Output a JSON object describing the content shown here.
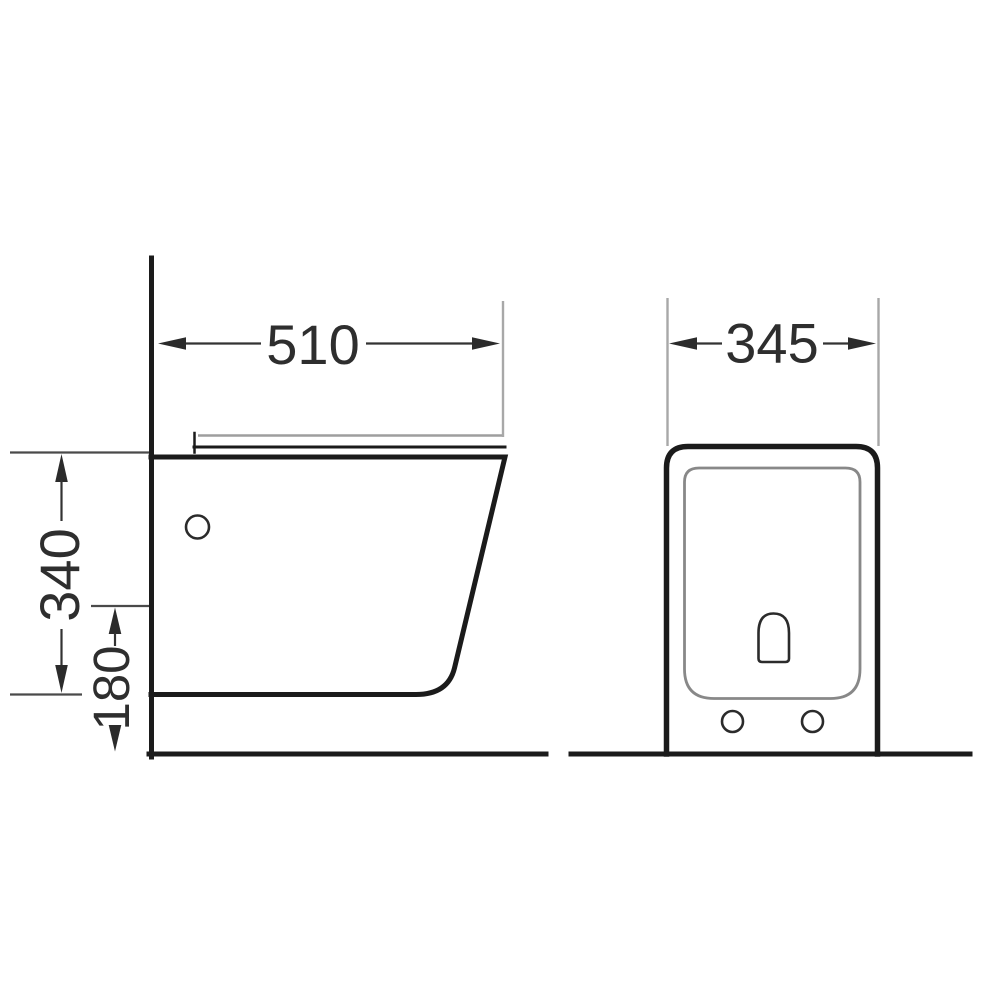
{
  "drawing": {
    "views": {
      "side": {
        "dim_width": "510",
        "dim_height": "340",
        "dim_outlet_height": "180"
      },
      "front": {
        "dim_width": "345"
      }
    },
    "colors": {
      "line": "#1b1b1b",
      "dimension": "#333333",
      "extension_gray": "#a8a8a8",
      "inner_gray": "#888888",
      "text": "#2e2e2e",
      "background": "#ffffff"
    }
  }
}
